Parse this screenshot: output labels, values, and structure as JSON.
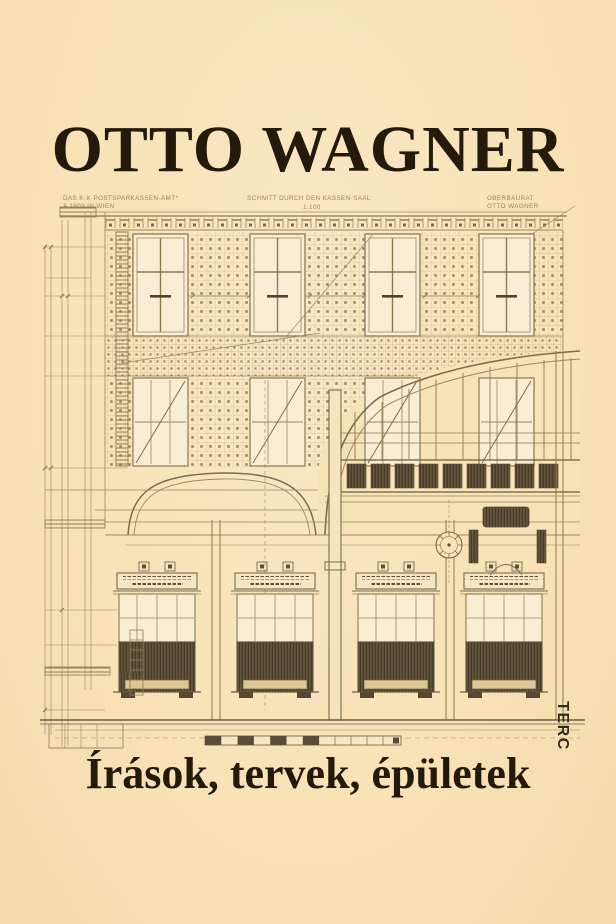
{
  "cover": {
    "title": "OTTO WAGNER",
    "subtitle": "Írások, tervek, épületek",
    "publisher_logo": "TERC"
  },
  "drawing": {
    "annotation_left_line1": "DAS K·K·POSTSPARKASSEN-AMT*",
    "annotation_left_line2": "A 1903 IN WIEN",
    "annotation_center_line1": "SCHNITT DURCH DEN KASSEN-SAAL",
    "annotation_center_scale": "1:100",
    "annotation_right_line1": "OBERBAURAT",
    "annotation_right_line2": "OTTO WAGNER"
  },
  "colors": {
    "background": "#f8e2b7",
    "ink": "#8f7c58",
    "ink_dark": "#6d5c42",
    "title_text": "#241a0c",
    "logo_text": "#352a1c"
  }
}
